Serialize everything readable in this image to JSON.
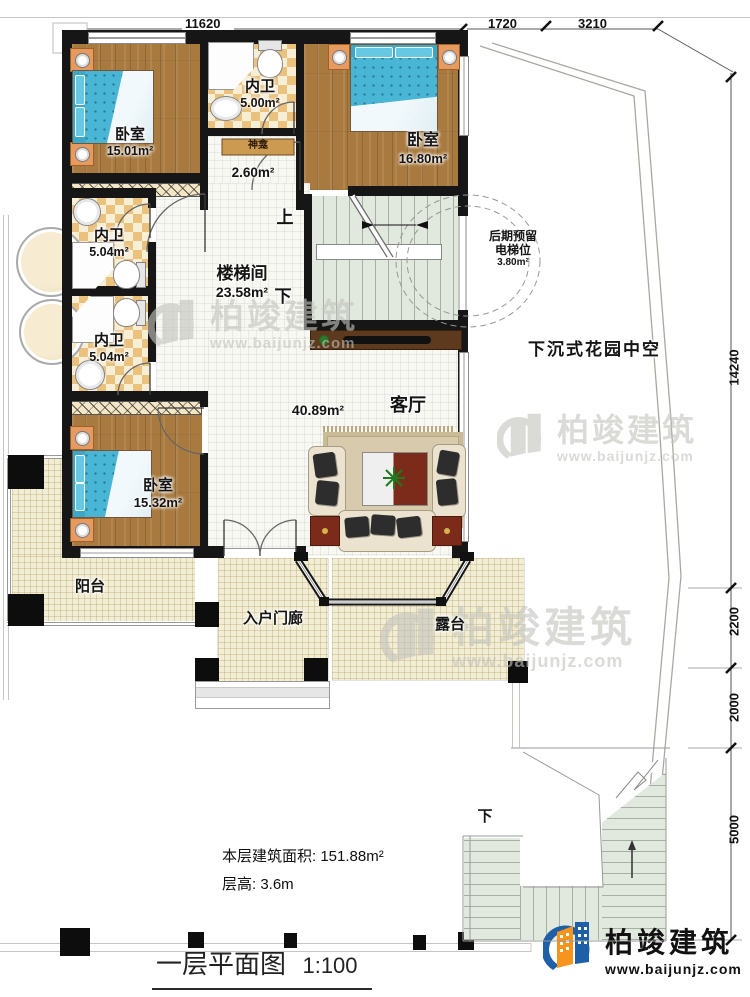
{
  "plan": {
    "rooms": {
      "bedroom_top_left": {
        "name": "卧室",
        "area": "15.01m²"
      },
      "bath_top": {
        "name": "内卫",
        "area": "5.00m²"
      },
      "shrine": {
        "name": "神龛",
        "area": "2.60m²"
      },
      "bedroom_top_right": {
        "name": "卧室",
        "area": "16.80m²"
      },
      "bath_mid": {
        "name": "内卫",
        "area": "5.04m²"
      },
      "bath_lower": {
        "name": "内卫",
        "area": "5.04m²"
      },
      "stair_hall": {
        "name": "楼梯间",
        "area": "23.58m²"
      },
      "bedroom_bottom": {
        "name": "卧室",
        "area": "15.32m²"
      },
      "living": {
        "name": "客厅",
        "area": "40.89m²"
      },
      "elevator_reserve": {
        "line1": "后期预留",
        "line2": "电梯位",
        "area": "3.80m²"
      },
      "sunken_garden": {
        "name": "下沉式花园中空"
      },
      "balcony": {
        "name": "阳台"
      },
      "entry_porch": {
        "name": "入户门廊"
      },
      "terrace": {
        "name": "露台"
      }
    },
    "stairs": {
      "up": "上",
      "down": "下",
      "outdoor_down": "下"
    },
    "dimensions": {
      "top": [
        "11620",
        "1720",
        "3210"
      ],
      "right": [
        "14240",
        "2200",
        "2000",
        "5000"
      ]
    },
    "notes": {
      "floor_area": "本层建筑面积: 151.88m²",
      "floor_height": "层高: 3.6m"
    },
    "title": {
      "name": "一层平面图",
      "scale": "1:100"
    },
    "brand": {
      "name": "柏竣建筑",
      "url": "www.baijunjz.com"
    },
    "colors": {
      "brand_blue": "#1f5fa8",
      "brand_orange": "#f7941e",
      "wall": "#161616"
    }
  }
}
